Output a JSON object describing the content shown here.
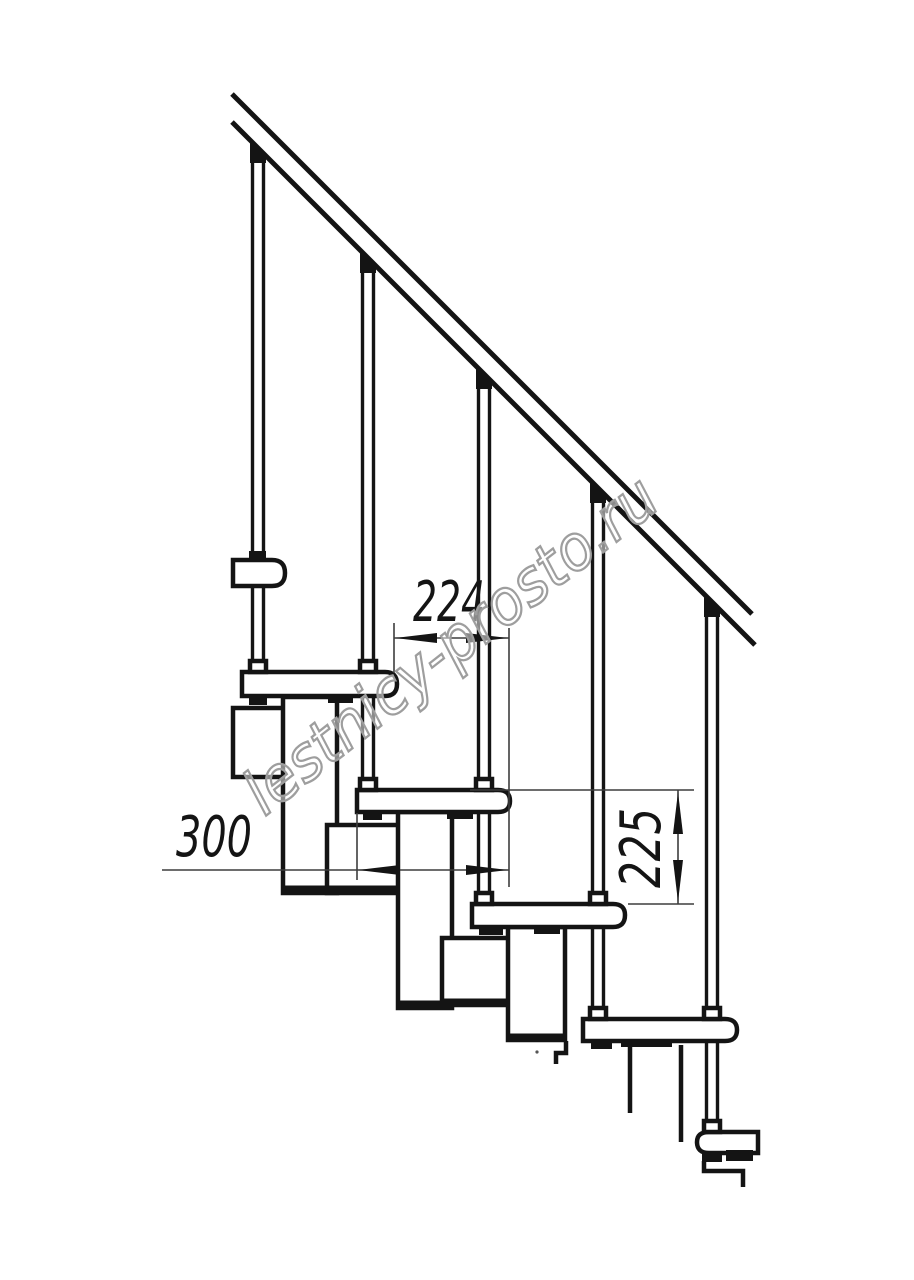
{
  "drawing": {
    "type": "modular-staircase-side-view",
    "watermark": "lestnicy-prosto.ru",
    "dimensions": {
      "step_run": "224",
      "tread_depth": "300",
      "step_rise": "225"
    },
    "colors": {
      "line": "#141414",
      "dimension_line": "#3d3d3d",
      "watermark_outline": "#9e9e9e",
      "background": "#ffffff"
    }
  }
}
